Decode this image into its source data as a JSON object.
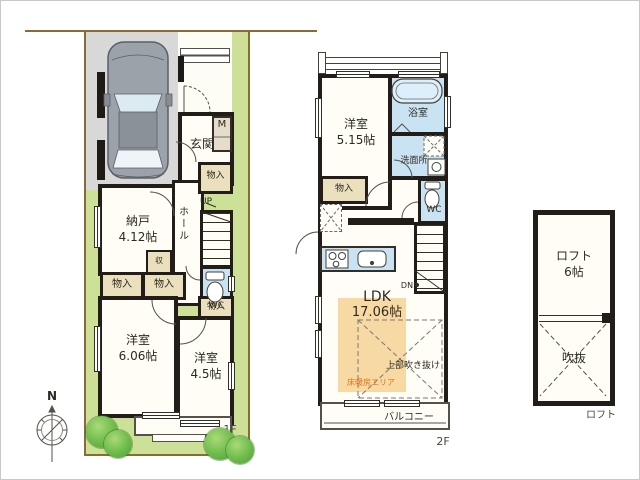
{
  "f1": {
    "floor_label": "1F",
    "entrance": "玄関",
    "meter": "M",
    "storage_room": "納戸",
    "storage_room_size": "4.12帖",
    "hall": "ホール",
    "up": "UP",
    "closet": "物入",
    "small_storage": "収",
    "wc": "WC",
    "bedroom1": "洋室",
    "bedroom1_size": "6.06帖",
    "bedroom2": "洋室",
    "bedroom2_size": "4.5帖"
  },
  "f2": {
    "floor_label": "2F",
    "bedroom": "洋室",
    "bedroom_size": "5.15帖",
    "bathroom": "浴室",
    "washroom": "洗面所",
    "closet": "物入",
    "wc": "WC",
    "ldk": "LDK",
    "ldk_size": "17.06帖",
    "down": "DN",
    "floor_heating": "床暖房エリア",
    "void_above": "上部吹き抜け",
    "balcony": "バルコニー"
  },
  "loft": {
    "name": "ロフト",
    "size": "6帖",
    "void": "吹抜",
    "floor_label": "ロフト"
  },
  "compass": {
    "north": "N"
  },
  "colors": {
    "site_green": "#cde098",
    "boundary_brown": "#8a6b35",
    "driveway_grey": "#d8d8d8",
    "wall_black": "#221d18",
    "wet_area_blue": "#c9e3f2",
    "closet_beige": "#eae0bd",
    "floor_heating_fill": "#f7d9a4",
    "floor_heating_text": "#e2761c"
  }
}
